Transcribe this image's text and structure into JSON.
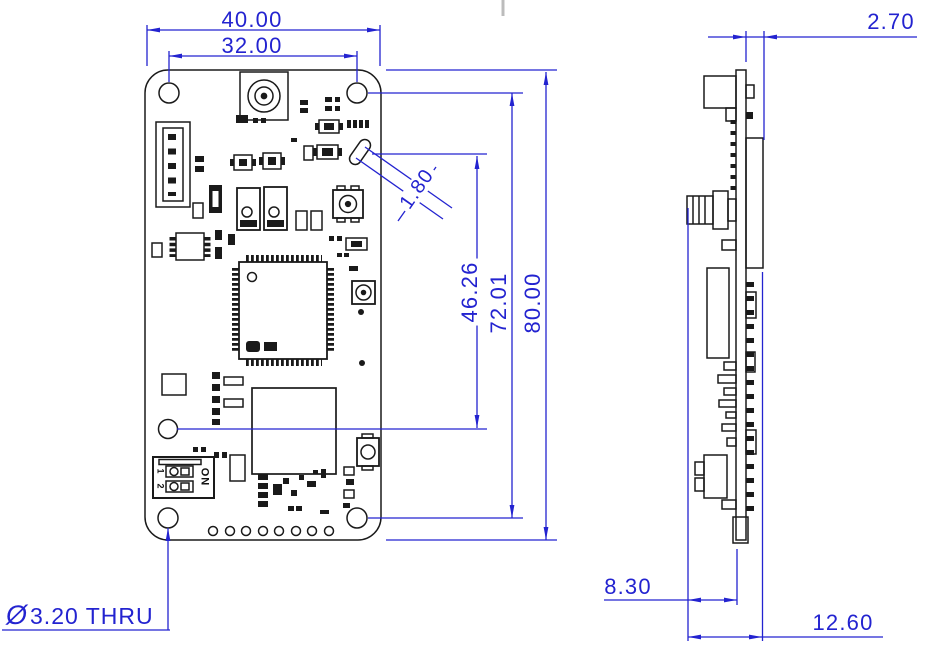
{
  "drawing": {
    "front_view": {
      "dims": {
        "overall_width": "40.00",
        "hole_pitch_width": "32.00",
        "overall_height": "80.00",
        "hole_pitch_height": "72.01",
        "slot_offset": "46.26",
        "slot_width": "1.80",
        "hole_callout_symbol": "Ø",
        "hole_callout_text": "3.20 THRU"
      },
      "silkscreen": {
        "dip_on": "ON",
        "dip_pos1": "1",
        "dip_pos2": "2"
      }
    },
    "side_view": {
      "dims": {
        "connector_offset": "2.70",
        "component_depth": "8.30",
        "overall_depth": "12.60"
      }
    },
    "colors": {
      "dimension_blue": "#2323d0",
      "drawing_black": "#1a1a1a",
      "centerline_gray": "#bcbcbc"
    }
  }
}
